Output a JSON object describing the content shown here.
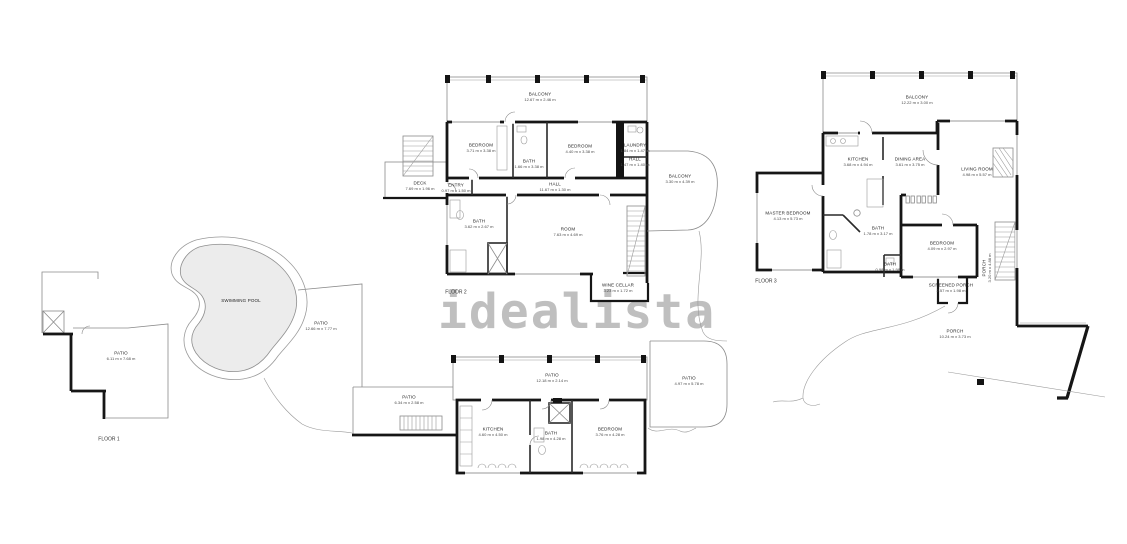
{
  "watermark": "idealista",
  "floors": [
    {
      "id": "floor-1",
      "label": "FLOOR 1",
      "label_pos": {
        "x": 109,
        "y": 439
      },
      "rooms": [
        {
          "name": "SWIMMING POOL",
          "dims": "",
          "x": 241,
          "y": 301
        },
        {
          "name": "PATIO",
          "dims": "12.66 m x 7.77 m",
          "x": 321,
          "y": 326
        },
        {
          "name": "PATIO",
          "dims": "6.11 m x 7.68 m",
          "x": 121,
          "y": 356
        },
        {
          "name": "PATIO",
          "dims": "12.18 m x 2.14 m",
          "x": 552,
          "y": 378
        },
        {
          "name": "PATIO",
          "dims": "6.34 m x 2.58 m",
          "x": 409,
          "y": 400
        },
        {
          "name": "PATIO",
          "dims": "4.97 m x 5.78 m",
          "x": 689,
          "y": 381
        },
        {
          "name": "KITCHEN",
          "dims": "4.60 m x 4.50 m",
          "x": 493,
          "y": 432
        },
        {
          "name": "BATH",
          "dims": "1.98 m x 4.28 m",
          "x": 551,
          "y": 436
        },
        {
          "name": "BEDROOM",
          "dims": "3.76 m x 4.28 m",
          "x": 610,
          "y": 432
        }
      ]
    },
    {
      "id": "floor-2",
      "label": "FLOOR 2",
      "label_pos": {
        "x": 456,
        "y": 292
      },
      "rooms": [
        {
          "name": "BALCONY",
          "dims": "12.67 m x 2.46 m",
          "x": 540,
          "y": 97
        },
        {
          "name": "BEDROOM",
          "dims": "3.71 m x 3.38 m",
          "x": 481,
          "y": 148
        },
        {
          "name": "BATH",
          "dims": "1.66 m x 3.38 m",
          "x": 529,
          "y": 164
        },
        {
          "name": "BEDROOM",
          "dims": "4.40 m x 3.38 m",
          "x": 580,
          "y": 149
        },
        {
          "name": "LAUNDRY",
          "dims": "1.84 m x 1.47 m",
          "x": 635,
          "y": 148
        },
        {
          "name": "HALL",
          "dims": "1.47 m x 1.40 m",
          "x": 635,
          "y": 162
        },
        {
          "name": "DECK",
          "dims": "7.69 m x 1.96 m",
          "x": 420,
          "y": 186
        },
        {
          "name": "ENTRY",
          "dims": "0.97 m x 1.50 m",
          "x": 456,
          "y": 188
        },
        {
          "name": "HALL",
          "dims": "11.67 m x 1.30 m",
          "x": 555,
          "y": 187
        },
        {
          "name": "BATH",
          "dims": "3.62 m x 2.67 m",
          "x": 479,
          "y": 224
        },
        {
          "name": "ROOM",
          "dims": "7.63 m x 4.69 m",
          "x": 568,
          "y": 232
        },
        {
          "name": "WINE CELLAR",
          "dims": "3.23 m x 1.72 m",
          "x": 618,
          "y": 288
        },
        {
          "name": "BALCONY",
          "dims": "3.30 m x 4.39 m",
          "x": 680,
          "y": 179
        }
      ]
    },
    {
      "id": "floor-3",
      "label": "FLOOR 3",
      "label_pos": {
        "x": 766,
        "y": 281
      },
      "rooms": [
        {
          "name": "BALCONY",
          "dims": "12.22 m x 3.00 m",
          "x": 917,
          "y": 100
        },
        {
          "name": "KITCHEN",
          "dims": "3.68 m x 4.94 m",
          "x": 858,
          "y": 162
        },
        {
          "name": "DINING AREA",
          "dims": "3.61 m x 3.75 m",
          "x": 910,
          "y": 162
        },
        {
          "name": "LIVING ROOM",
          "dims": "4.98 m x 5.57 m",
          "x": 977,
          "y": 172
        },
        {
          "name": "MASTER BEDROOM",
          "dims": "4.13 m x 5.73 m",
          "x": 788,
          "y": 216
        },
        {
          "name": "BATH",
          "dims": "1.78 m x 3.17 m",
          "x": 878,
          "y": 231
        },
        {
          "name": "BEDROOM",
          "dims": "4.09 m x 2.97 m",
          "x": 942,
          "y": 246
        },
        {
          "name": "BATH",
          "dims": "0.98 m x 1.98 m",
          "x": 890,
          "y": 267
        },
        {
          "name": "SCREENED PORCH",
          "dims": "2.57 m x 1.98 m",
          "x": 951,
          "y": 288
        },
        {
          "name": "PORCH",
          "dims": "3.20 m x 4.88 m",
          "x": 987,
          "y": 268,
          "vertical": true
        },
        {
          "name": "PORCH",
          "dims": "10.24 m x 3.73 m",
          "x": 955,
          "y": 334
        }
      ]
    }
  ]
}
